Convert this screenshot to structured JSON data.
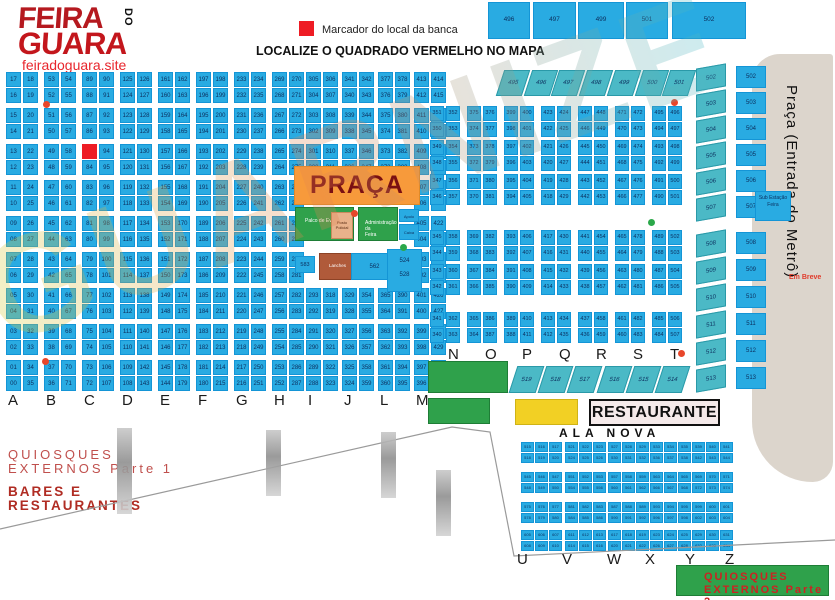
{
  "header": {
    "logo_line1": "FEIRA",
    "logo_do": "DO",
    "logo_line2": "GUARA",
    "site": "feiradoguara.site"
  },
  "legend": {
    "label": "Marcador do local da banca"
  },
  "title": "LOCALIZE O QUADRADO VERMELHO NO MAPA",
  "watermark": "GUARNIZE",
  "top_blocks": [
    "496",
    "497",
    "499",
    "501",
    "502"
  ],
  "strip_top": [
    "495",
    "496",
    "497",
    "498",
    "499",
    "500",
    "501"
  ],
  "strip_mid": [
    "519",
    "518",
    "517",
    "516",
    "515",
    "514"
  ],
  "right_columns": {
    "slanted": [
      "502",
      "503",
      "504",
      "505",
      "506",
      "507",
      "508",
      "509",
      "510",
      "511",
      "512",
      "513"
    ],
    "rects": [
      "502",
      "503",
      "504",
      "505",
      "506",
      "507",
      "508",
      "509",
      "510",
      "511",
      "512",
      "513"
    ]
  },
  "metro": {
    "label": "Praça (Entrada do Metrô)",
    "em_breve": "Em Breve",
    "substation": "Sub Estação Feira"
  },
  "left_grid": {
    "letters": [
      "A",
      "B",
      "C",
      "D",
      "E",
      "F",
      "G",
      "H",
      "I",
      "J",
      "L",
      "M"
    ],
    "start": 0,
    "step": 36,
    "rows": 18
  },
  "right_grid": {
    "letters": [
      "N",
      "O",
      "P",
      "Q",
      "R",
      "S",
      "T"
    ],
    "start": 340,
    "step": 24,
    "rows": 12
  },
  "praca": {
    "title": "PRAÇA",
    "stage": "Palco de Eventos",
    "posto": "Posto Policial",
    "adm": "Administração da Feira",
    "apoio": "Apoio",
    "caixa": "Caixa",
    "n583": "583",
    "lanches": "Lanches",
    "n562": "562",
    "n524": "524",
    "n528": "528"
  },
  "restaurante": "RESTAURANTE",
  "ala_nova": {
    "title": "ALA NOVA",
    "letters": [
      "U",
      "V",
      "W",
      "X",
      "Y",
      "Z"
    ],
    "start": 515,
    "per_block": 6
  },
  "quiosques1": {
    "l1": "QUIOSQUES",
    "l2": "EXTERNOS Parte 1",
    "l3": "BARES E",
    "l4": "RESTAURANTES"
  },
  "quiosques2": {
    "l1": "QUIOSQUES",
    "l2": "EXTERNOS Parte 2"
  },
  "colors": {
    "stall_blue": "#29abe2",
    "strip_teal": "#4bb9c6",
    "praca_orange": "#f79a3b",
    "green": "#2fa14b",
    "yellow": "#f2d024",
    "marker_red": "#ee1c24",
    "logo_red": "#c3161c",
    "metro_gray": "#dcd5cc"
  }
}
